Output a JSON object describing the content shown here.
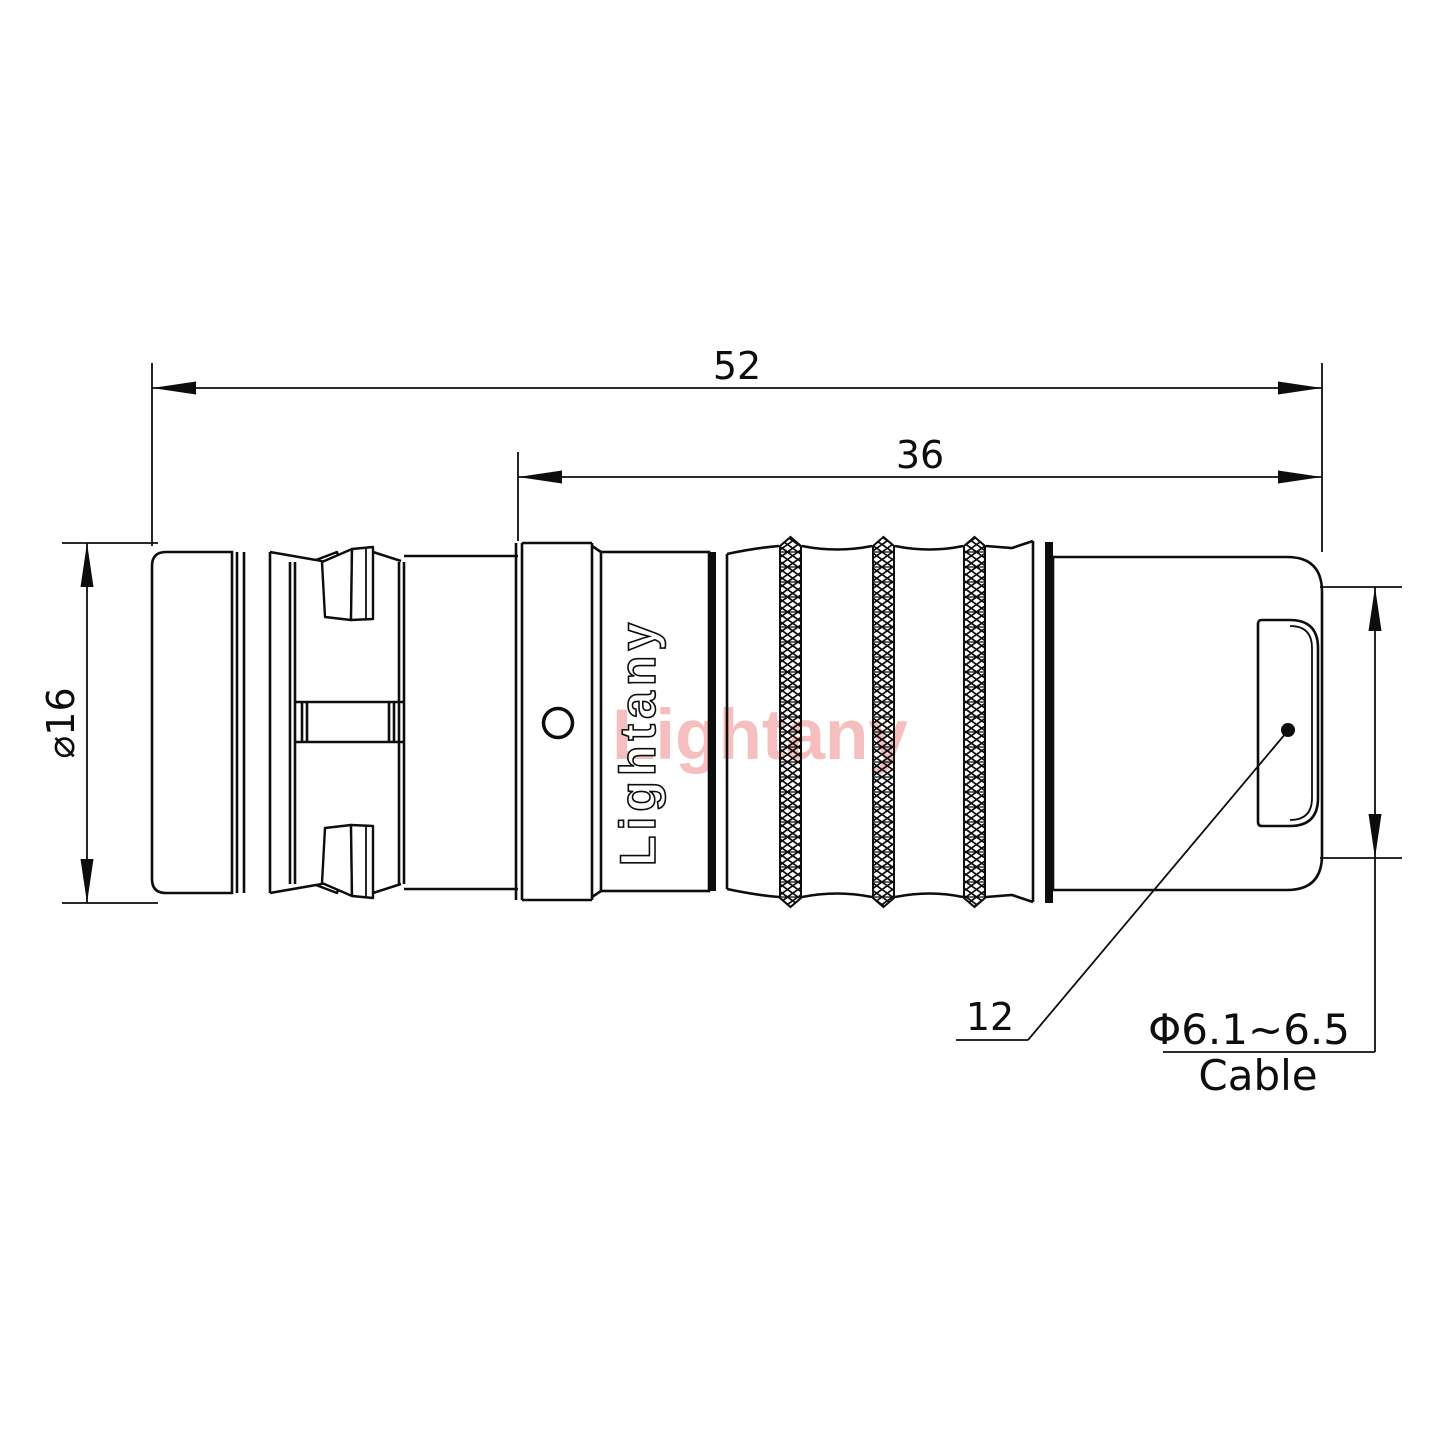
{
  "drawing": {
    "dimensions": {
      "overall_length": "52",
      "rear_length": "36",
      "body_diameter": "⌀16",
      "nut_ref": "12",
      "cable_range": "Φ6.1~6.5",
      "cable_label": "Cable"
    },
    "branding": {
      "body_text": "Lightany",
      "watermark": "Lightany"
    },
    "colors": {
      "line": "#0d0d0d",
      "watermark": "#f6bfbf",
      "background": "#ffffff"
    }
  }
}
